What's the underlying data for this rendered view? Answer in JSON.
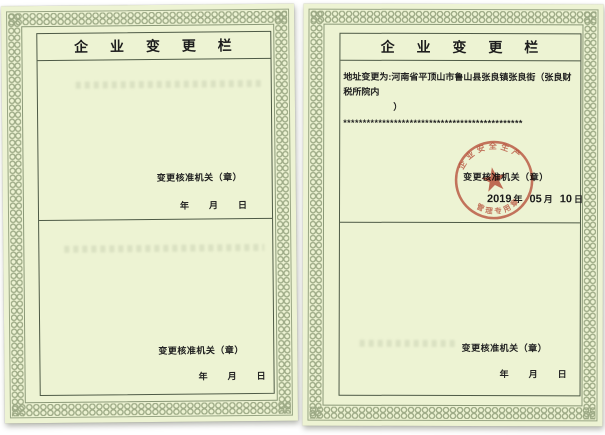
{
  "left_page": {
    "title": "企 业 变 更 栏",
    "sections": [
      {
        "authority_label": "变更核准机关（章）",
        "year_label": "年",
        "month_label": "月",
        "day_label": "日"
      },
      {
        "authority_label": "变更核准机关（章）",
        "year_label": "年",
        "month_label": "月",
        "day_label": "日"
      }
    ]
  },
  "right_page": {
    "title": "企 业 变 更 栏",
    "entry": {
      "line1": "地址变更为:河南省平顶山市鲁山县张良镇张良街（张良财税所院内",
      "line2": "）",
      "terminator": "**********************************************"
    },
    "sections": [
      {
        "authority_label": "变更核准机关（章）",
        "year_value": "2019",
        "year_label": "年",
        "month_value": "05",
        "month_label": "月",
        "day_value": "10",
        "day_label": "日"
      },
      {
        "authority_label": "变更核准机关（章）",
        "year_label": "年",
        "month_label": "月",
        "day_label": "日"
      }
    ],
    "seal": {
      "top_arc_text": "企业安全生产",
      "bottom_arc_text": "管理专用章"
    }
  },
  "colors": {
    "page_background": "#edf3d3",
    "border_pattern": "#9aa783",
    "rule_line": "#4e5a46",
    "text": "#1d1d1d",
    "seal_red": "#c0493a"
  }
}
